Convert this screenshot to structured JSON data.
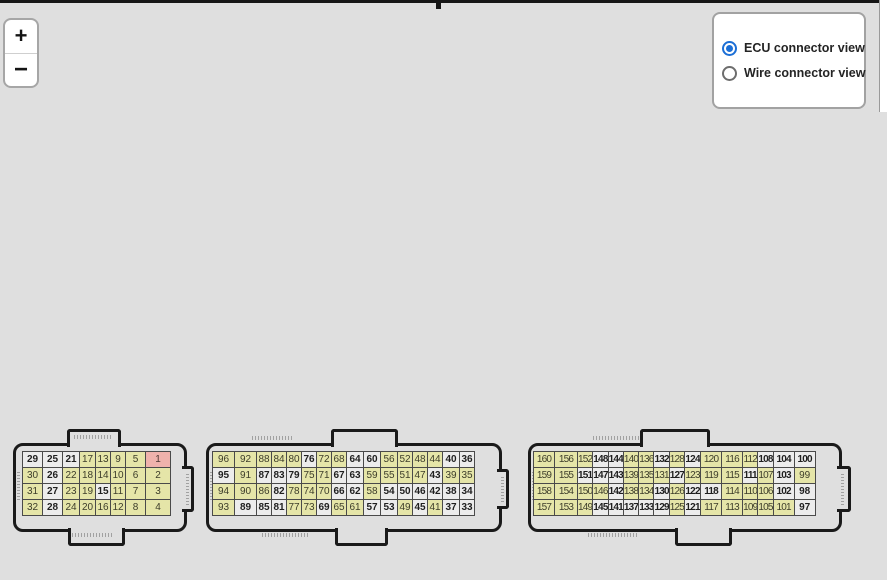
{
  "toolbar": {
    "zoom_in_label": "+",
    "zoom_out_label": "−"
  },
  "view_toggle": {
    "options": [
      {
        "label": "ECU connector view",
        "selected": true
      },
      {
        "label": "Wire connector view",
        "selected": false
      }
    ]
  },
  "colors": {
    "pin_default_yellow": "#e5e5a8",
    "pin_white": "#ececec",
    "pin_highlight_pink": "#efb2ac",
    "radio_accent_blue": "#1c6fd6",
    "connector_outline": "#1a1a1a",
    "canvas_background": "#dfdfdf"
  },
  "connectors": [
    {
      "id": "connector-1",
      "rows": [
        [
          "29",
          "25",
          "21",
          "17",
          "13",
          "9",
          "5",
          "1"
        ],
        [
          "30",
          "26",
          "22",
          "18",
          "14",
          "10",
          "6",
          "2"
        ],
        [
          "31",
          "27",
          "23",
          "19",
          "15",
          "11",
          "7",
          "3"
        ],
        [
          "32",
          "28",
          "24",
          "20",
          "16",
          "12",
          "8",
          "4"
        ]
      ],
      "white_pins": [
        "29",
        "25",
        "21",
        "26",
        "27",
        "28",
        "15"
      ],
      "highlighted_pins": [
        "1"
      ]
    },
    {
      "id": "connector-2",
      "rows": [
        [
          "96",
          "92",
          "88",
          "84",
          "80",
          "76",
          "72",
          "68",
          "64",
          "60",
          "56",
          "52",
          "48",
          "44",
          "40",
          "36"
        ],
        [
          "95",
          "91",
          "87",
          "83",
          "79",
          "75",
          "71",
          "67",
          "63",
          "59",
          "55",
          "51",
          "47",
          "43",
          "39",
          "35"
        ],
        [
          "94",
          "90",
          "86",
          "82",
          "78",
          "74",
          "70",
          "66",
          "62",
          "58",
          "54",
          "50",
          "46",
          "42",
          "38",
          "34"
        ],
        [
          "93",
          "89",
          "85",
          "81",
          "77",
          "73",
          "69",
          "65",
          "61",
          "57",
          "53",
          "49",
          "45",
          "41",
          "37",
          "33"
        ]
      ],
      "white_pins": [
        "76",
        "64",
        "60",
        "40",
        "36",
        "95",
        "87",
        "83",
        "79",
        "67",
        "63",
        "43",
        "82",
        "66",
        "62",
        "54",
        "50",
        "46",
        "42",
        "38",
        "34",
        "89",
        "85",
        "81",
        "69",
        "57",
        "53",
        "45",
        "37",
        "33"
      ],
      "highlighted_pins": []
    },
    {
      "id": "connector-3",
      "rows": [
        [
          "160",
          "156",
          "152",
          "148",
          "144",
          "140",
          "136",
          "132",
          "128",
          "124",
          "120",
          "116",
          "112",
          "108",
          "104",
          "100"
        ],
        [
          "159",
          "155",
          "151",
          "147",
          "143",
          "139",
          "135",
          "131",
          "127",
          "123",
          "119",
          "115",
          "111",
          "107",
          "103",
          "99"
        ],
        [
          "158",
          "154",
          "150",
          "146",
          "142",
          "138",
          "134",
          "130",
          "126",
          "122",
          "118",
          "114",
          "110",
          "106",
          "102",
          "98"
        ],
        [
          "157",
          "153",
          "149",
          "145",
          "141",
          "137",
          "133",
          "129",
          "125",
          "121",
          "117",
          "113",
          "109",
          "105",
          "101",
          "97"
        ]
      ],
      "white_pins": [
        "148",
        "144",
        "132",
        "124",
        "108",
        "104",
        "100",
        "151",
        "147",
        "143",
        "127",
        "111",
        "103",
        "142",
        "130",
        "122",
        "118",
        "102",
        "98",
        "145",
        "141",
        "137",
        "133",
        "129",
        "121",
        "97"
      ],
      "highlighted_pins": []
    }
  ]
}
